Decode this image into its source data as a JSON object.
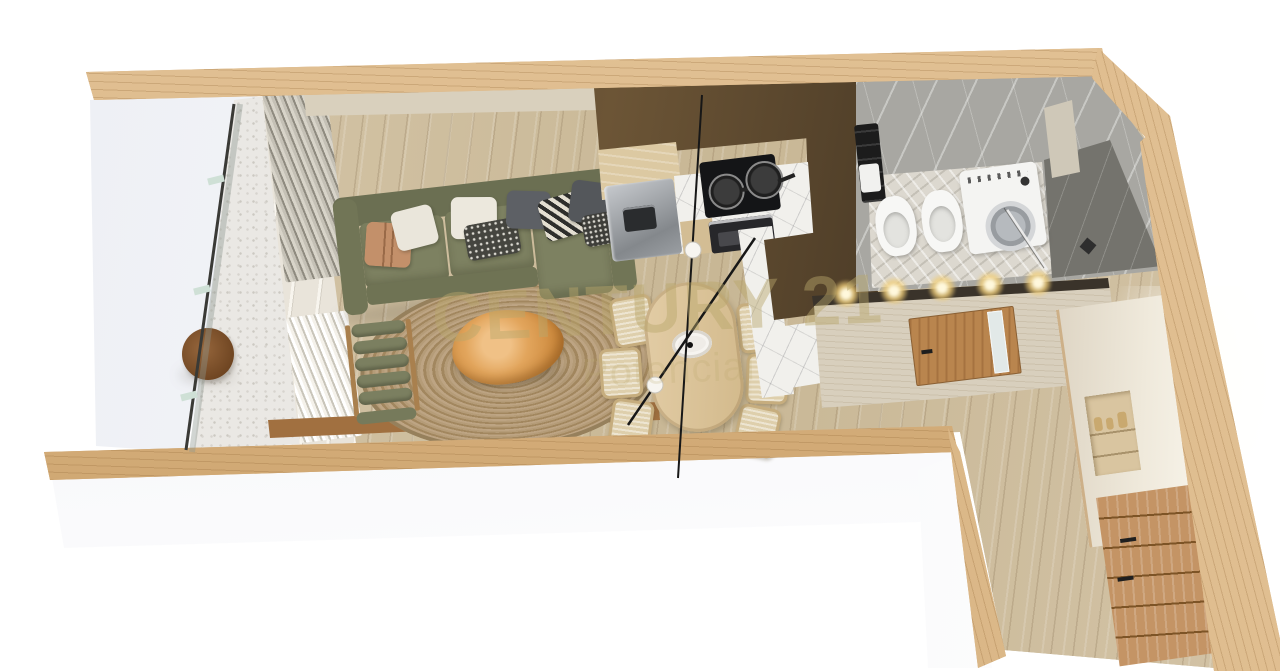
{
  "image_type": "photorealistic 3D top-down floor plan render of a studio apartment",
  "watermark": {
    "title": "CENTURY 21",
    "subtitle": "Potencial",
    "color": "#b9a76b"
  },
  "rooms": {
    "balcony": {
      "features": [
        "glass-railing",
        "stone-terrazzo-floor",
        "round-walnut-side-table"
      ]
    },
    "living_room": {
      "features": [
        "olive-green-sofa-with-chaise",
        "eight-throw-pillows",
        "round-jute-rug",
        "live-edge-wood-coffee-table",
        "olive-bolster-lounge-chair",
        "low-wood-console",
        "pleated-curtains",
        "window-wall"
      ]
    },
    "dining_area": {
      "features": [
        "oval-light-wood-table",
        "six-wood-chairs",
        "black-linear-pendant-with-two-globes",
        "white-serving-plate"
      ]
    },
    "kitchen": {
      "features": [
        "dark-bronze-upper-cabinets",
        "stainless-steel-fridge",
        "marble-backsplash",
        "black-cooktop-with-two-pans",
        "built-in-oven",
        "marble-and-bronze-peninsula"
      ]
    },
    "bathroom": {
      "features": [
        "gray-marble-walls",
        "patterned-tile-floor",
        "toilet",
        "bidet",
        "washing-machine",
        "dark-marble-walk-in-shower",
        "glass-partition",
        "black-towel-radiator",
        "wall-niche"
      ]
    },
    "hallway": {
      "features": [
        "travertine-partition-wall",
        "wood-door-with-glass-strip",
        "ceiling-spotlights"
      ]
    },
    "entry_storage": {
      "features": [
        "cream-wardrobe-with-display-niche",
        "oak-drawer-chest"
      ]
    }
  },
  "palette": {
    "wall_wood": "#d6af7d",
    "floor_wood": "#cdbd9f",
    "sofa_olive": "#7b7f5f",
    "rug_jute": "#ae9571",
    "kitchen_bronze": "#54422b",
    "bathroom_marble": "#a8a7a2",
    "background": "#ffffff"
  }
}
